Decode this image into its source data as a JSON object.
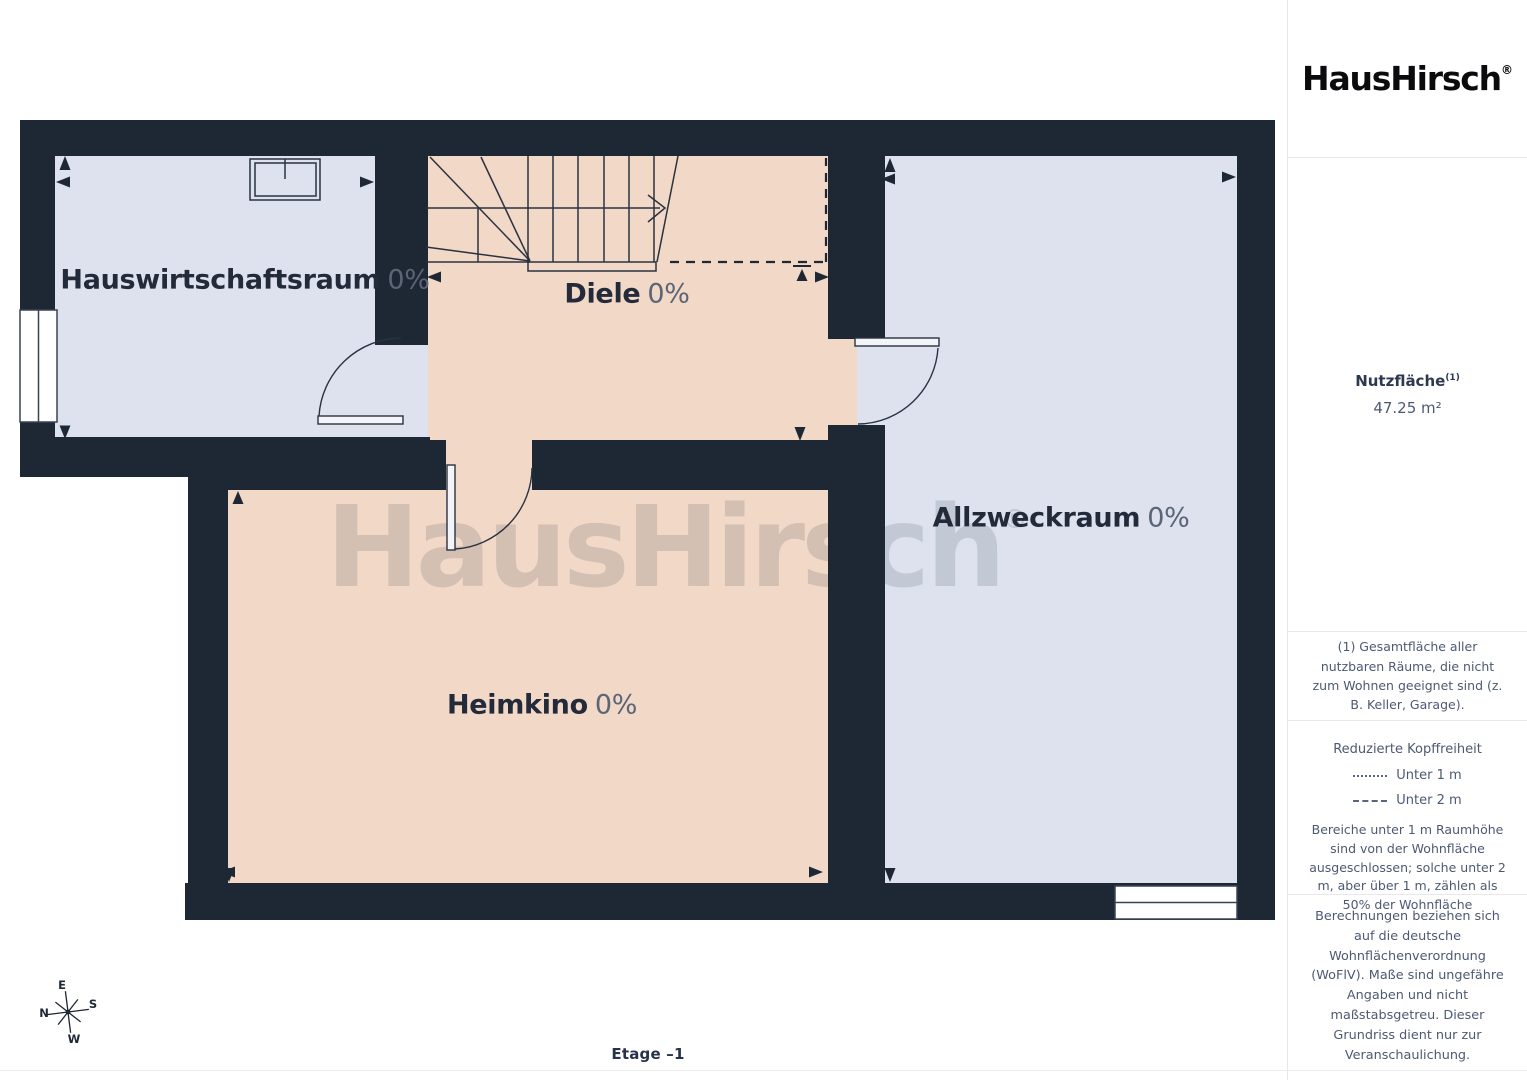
{
  "brand": {
    "logo_text": "HausHirsch",
    "registered_mark": "®"
  },
  "watermark": {
    "text": "HausHirsch",
    "registered_mark": "®"
  },
  "floor_label": "Etage –1",
  "rooms": [
    {
      "name": "Hauswirtschaftsraum",
      "percent": "0%"
    },
    {
      "name": "Diele",
      "percent": "0%"
    },
    {
      "name": "Allzweckraum",
      "percent": "0%"
    },
    {
      "name": "Heimkino",
      "percent": "0%"
    }
  ],
  "compass": {
    "n": "N",
    "e": "E",
    "s": "S",
    "w": "W"
  },
  "sidebar": {
    "area": {
      "label": "Nutzfläche",
      "footnote_marker": "(1)",
      "value": "47.25 m²"
    },
    "footnote": "(1) Gesamtfläche aller nutzbaren Räume, die nicht zum Wohnen geeignet sind (z. B. Keller, Garage).",
    "headroom": {
      "title": "Reduzierte Kopffreiheit",
      "legend": [
        {
          "style": "dotted",
          "label": "Unter 1 m"
        },
        {
          "style": "dashed",
          "label": "Unter 2 m"
        }
      ],
      "note": "Bereiche unter 1 m Raumhöhe sind von der Wohnfläche ausgeschlossen; solche unter 2 m, aber über 1 m, zählen als 50% der Wohnfläche"
    },
    "disclaimer": "Berechnungen beziehen sich auf die deutsche Wohnflächenverordnung (WoFlV). Maße sind ungefähre Angaben und nicht maßstabsgetreu. Dieser Grundriss dient nur zur Veranschaulichung.",
    "credit": {
      "name": "GIRAFFE",
      "suffix": "360"
    }
  },
  "colors": {
    "wall": "#1e2734",
    "room_blue": "#dde2ee",
    "room_peach": "#f2d8c7",
    "label_dark": "#232b3b",
    "label_muted": "#5b6577",
    "sidebar_text": "#4d5972"
  }
}
